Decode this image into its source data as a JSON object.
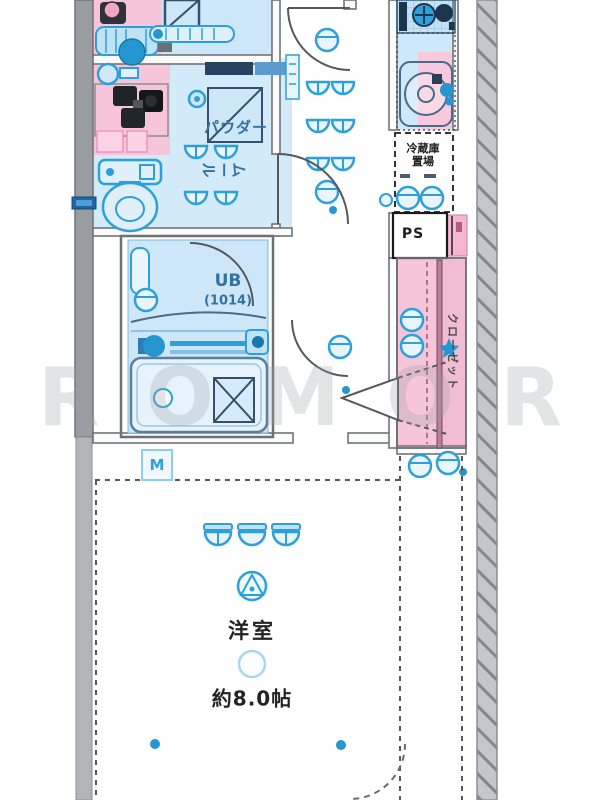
{
  "plan": {
    "rooms": {
      "powder_room": {
        "label_line1": "パウダー",
        "label_line2": "ルーム"
      },
      "unit_bath": {
        "label": "UB",
        "size": "(1014)"
      },
      "refrigerator_space": {
        "label_line1": "冷蔵庫",
        "label_line2": "置場"
      },
      "pipe_space": {
        "label": "PS"
      },
      "closet": {
        "label": "クローゼット"
      },
      "western_room": {
        "label": "洋室",
        "size": "約8.0帖"
      },
      "meter_box": {
        "label": "M"
      }
    },
    "watermark": {
      "letters": [
        "R",
        "O",
        "M",
        "O",
        "R"
      ]
    },
    "colors": {
      "room_blue": "#cde7f8",
      "fixture_blue": "#2da0dc",
      "pink": "#f6c5da",
      "wall_gray": "#999da1",
      "hatch_gray": "#c3c7cb",
      "label_navy": "#35719f",
      "text_black": "#1c1c1c"
    }
  }
}
